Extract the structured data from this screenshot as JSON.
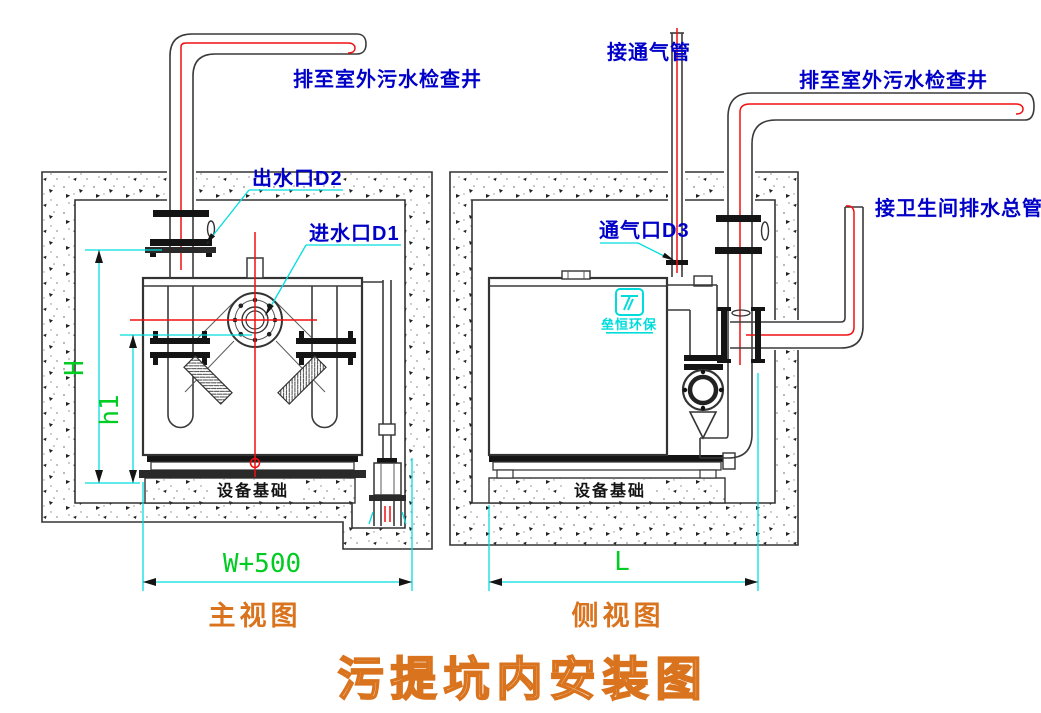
{
  "title": "污提坑内安装图",
  "front_view": {
    "caption": "主视图",
    "labels": {
      "discharge_pipe": "排至室外污水检查井",
      "outlet_port": "出水口D2",
      "inlet_port": "进水口D1",
      "foundation": "设备基础"
    },
    "dimensions": {
      "overall_height": "H",
      "inlet_height": "h1",
      "pit_width": "W+500"
    }
  },
  "side_view": {
    "caption": "侧视图",
    "labels": {
      "vent_pipe": "接通气管",
      "discharge_pipe": "排至室外污水检查井",
      "vent_port": "通气口D3",
      "toilet_drain_main": "接卫生间排水总管",
      "foundation": "设备基础"
    },
    "dimensions": {
      "pit_length": "L"
    }
  },
  "logo": {
    "text": "垒恒环保",
    "icon_name": "stylized-t-mark-icon"
  },
  "colors": {
    "label_blue": "#0000C8",
    "dimension_cyan": "#00DEDE",
    "dimension_green": "#00CC22",
    "centerline_red": "#F01010",
    "caption_orange": "#D9731E",
    "drawing_line": "#3A3A3A"
  }
}
